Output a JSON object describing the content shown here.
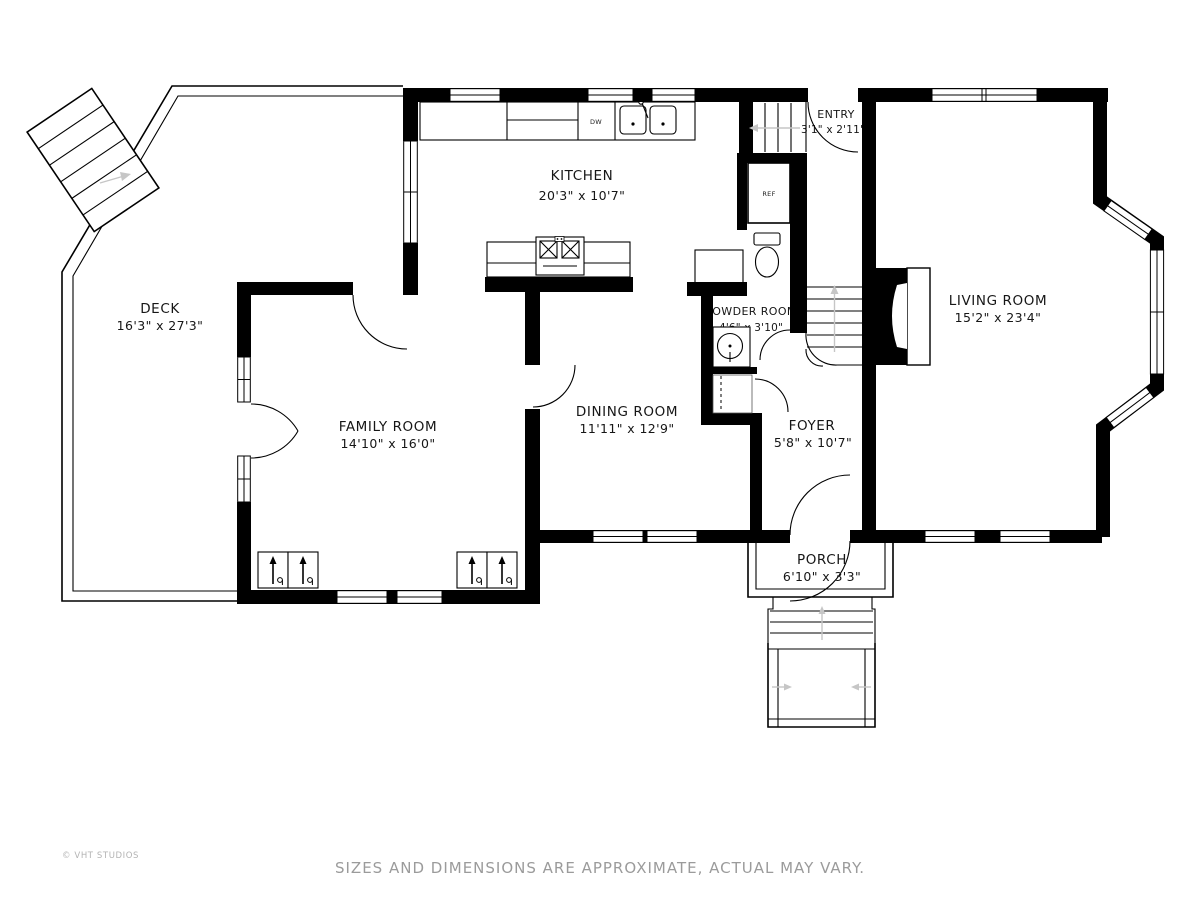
{
  "rooms": {
    "kitchen": {
      "name": "KITCHEN",
      "dims": "20'3\" x 10'7\""
    },
    "entry": {
      "name": "ENTRY",
      "dims": "3'1\" x 2'11\""
    },
    "living": {
      "name": "LIVING ROOM",
      "dims": "15'2\" x 23'4\""
    },
    "deck": {
      "name": "DECK",
      "dims": "16'3\" x 27'3\""
    },
    "family": {
      "name": "FAMILY ROOM",
      "dims": "14'10\" x 16'0\""
    },
    "dining": {
      "name": "DINING ROOM",
      "dims": "11'11\" x 12'9\""
    },
    "powder": {
      "name": "POWDER ROOM",
      "dims": "4'6\" x 3'10\""
    },
    "foyer": {
      "name": "FOYER",
      "dims": "5'8\" x 10'7\""
    },
    "porch": {
      "name": "PORCH",
      "dims": "6'10\" x 3'3\""
    }
  },
  "appliances": {
    "refrigerator": "REF",
    "dishwasher": "DW"
  },
  "footer": {
    "watermark": "© VHT STUDIOS",
    "disclaimer": "SIZES AND DIMENSIONS ARE APPROXIMATE, ACTUAL MAY VARY."
  },
  "colors": {
    "wall": "#000000",
    "label_text": "#161616",
    "muted_text": "#9b9b9b",
    "guide_arrow": "#c6c6c6"
  }
}
